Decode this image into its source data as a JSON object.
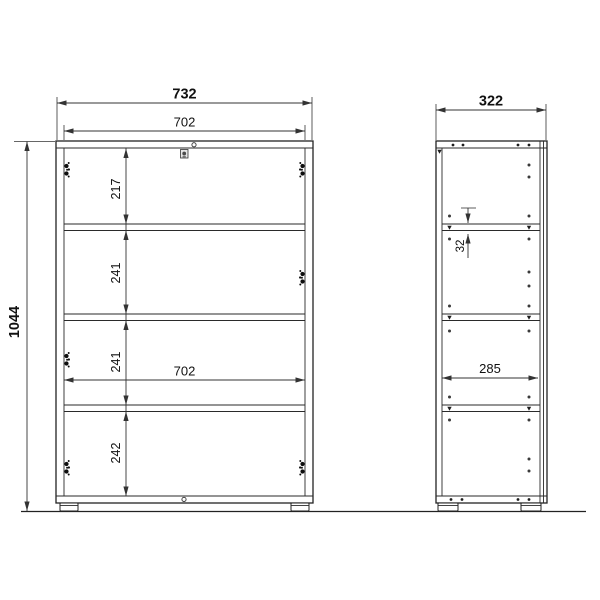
{
  "front_view": {
    "overall_width_mm": "732",
    "inner_width_mm": "702",
    "overall_height_mm": "1044",
    "inner_width_mid_mm": "702",
    "compartments": {
      "c1": "217",
      "c2": "241",
      "c3": "241",
      "c4": "242"
    }
  },
  "side_view": {
    "overall_depth_mm": "322",
    "inner_depth_mm": "285",
    "hole_offset_mm": "32"
  }
}
